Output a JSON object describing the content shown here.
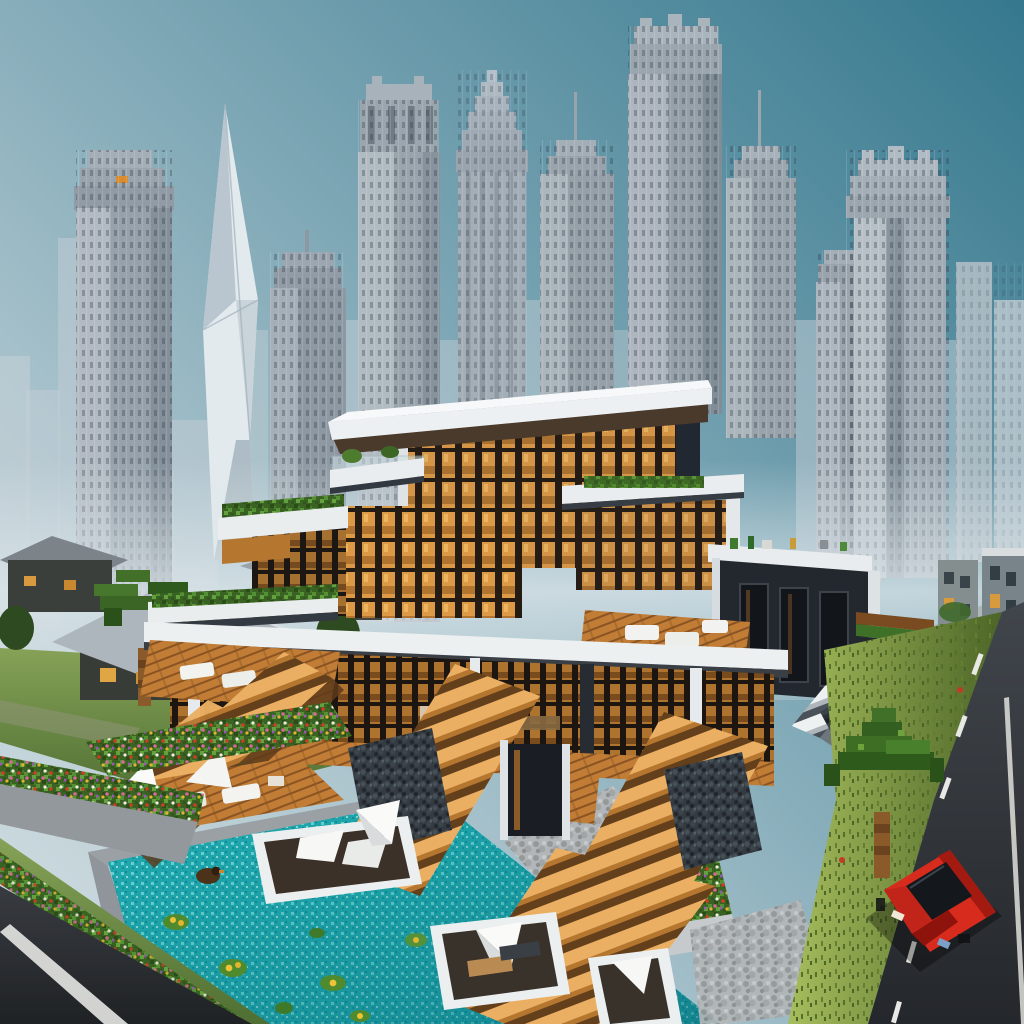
{
  "meta": {
    "title": "Voxel-style render: terraced luxury villa with pool in front of a skyscraper skyline",
    "style": "3D Minecraft-like architectural render, golden interior lighting, clear teal sky",
    "canvas": {
      "width": 1024,
      "height": 1024
    }
  },
  "palette": {
    "sky_top_right": "#35788e",
    "sky_bottom_left": "#d3dfe2",
    "tower_gray": "#96a1ab",
    "tower_lit": "#b9c2c9",
    "tower_haze": "#c3ced5",
    "twisted_tower_light": "#e3eaee",
    "villa_white": "#edf0f2",
    "villa_charcoal": "#262c33",
    "glass_warm": "#dd9a46",
    "wood_deck": "#c17d35",
    "stair_tread": "#eaaf62",
    "hedge_green": "#3a6323",
    "pool_turquoise": "#21acb1",
    "stone_pebble": "#b3b6b8",
    "grass": "#86a257",
    "road_asphalt": "#2c2f34",
    "road_marking": "#e6e7e3",
    "car_red": "#d62b1d",
    "flower_red": "#cf3b26",
    "flower_yellow": "#e2b52e",
    "palm_green": "#3e6e24",
    "palm_trunk": "#8a5a2b"
  },
  "regions": {
    "sky": {
      "label": "Clear teal sky, light haze toward lower left"
    },
    "skyline": {
      "label": "Dense downtown skyline of gray voxel skyscrapers",
      "tower_count": 12,
      "landmarks": [
        "twisted faceted spire",
        "tiered petronas-style crown",
        "flat-top supertall",
        "ornate art-deco crowns"
      ]
    },
    "village": {
      "label": "Low wooden houses, lawn and pixel palm at left",
      "house_count": 3
    },
    "background_right": {
      "label": "Hazy overgrown blocks, stepped ziggurat and curved road at right"
    },
    "villa": {
      "label": "Four-level cantilevered villa, amber-lit glass walls, roof gardens, five wooden staircases",
      "levels": 4,
      "staircase_count": 5,
      "roof_gardens": true,
      "white_stair_right": true
    },
    "pool": {
      "label": "Turquoise mosaic pool with floating lounge islands",
      "island_count": 3,
      "lily_pads": 7,
      "duck_float": 1
    },
    "gardens": {
      "label": "Planters, hedges and flower beds",
      "flower_colors": [
        "red",
        "pink",
        "yellow",
        "purple",
        "white"
      ]
    },
    "roads": {
      "label": "Asphalt roads with white lane markings",
      "count": 2
    },
    "car": {
      "label": "Red voxel sports car on right road",
      "color_name": "red"
    },
    "palms": {
      "label": "Blocky palm trees",
      "count": 2
    }
  }
}
